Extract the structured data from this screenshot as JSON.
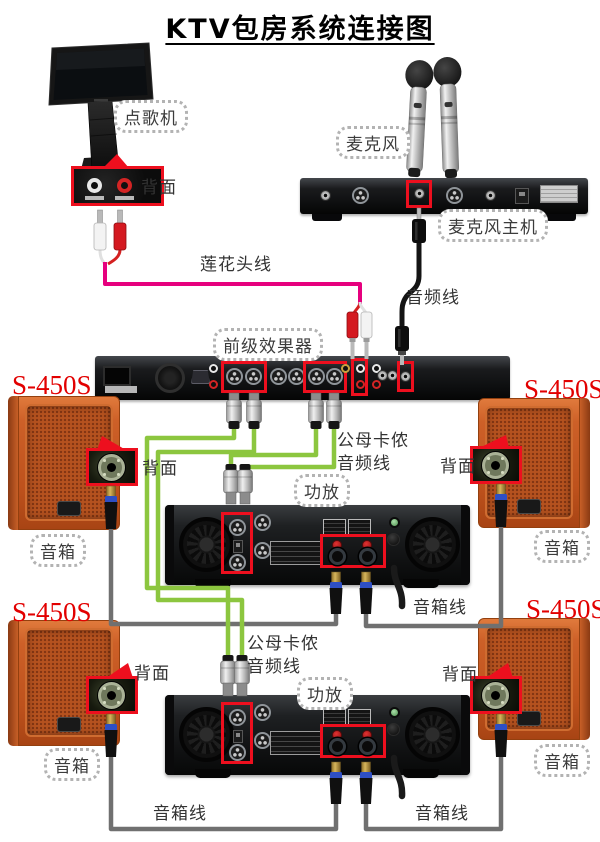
{
  "title": "KTV包房系统连接图",
  "labels": {
    "song_machine": "点歌机",
    "microphones": "麦克风",
    "mic_receiver": "麦克风主机",
    "effects_processor": "前级效果器",
    "amplifier": "功放",
    "back_view": "背面",
    "speaker_model": "S-450S",
    "speaker_box": "音箱"
  },
  "cables": {
    "rca_cable": "莲花头线",
    "audio_cable": "音频线",
    "xlr_line1": "公母卡侬",
    "xlr_line2": "音频线",
    "speaker_cable": "音箱线"
  },
  "colors": {
    "highlight_red": "#ed0f1e",
    "rca_cable_pink": "#e6007e",
    "xlr_cable_green": "#8cc63f",
    "speaker_cable_gray": "#707070",
    "audio_cable_black": "#141414",
    "speaker_orange": "#c95d28",
    "model_text_red": "#e20000"
  }
}
